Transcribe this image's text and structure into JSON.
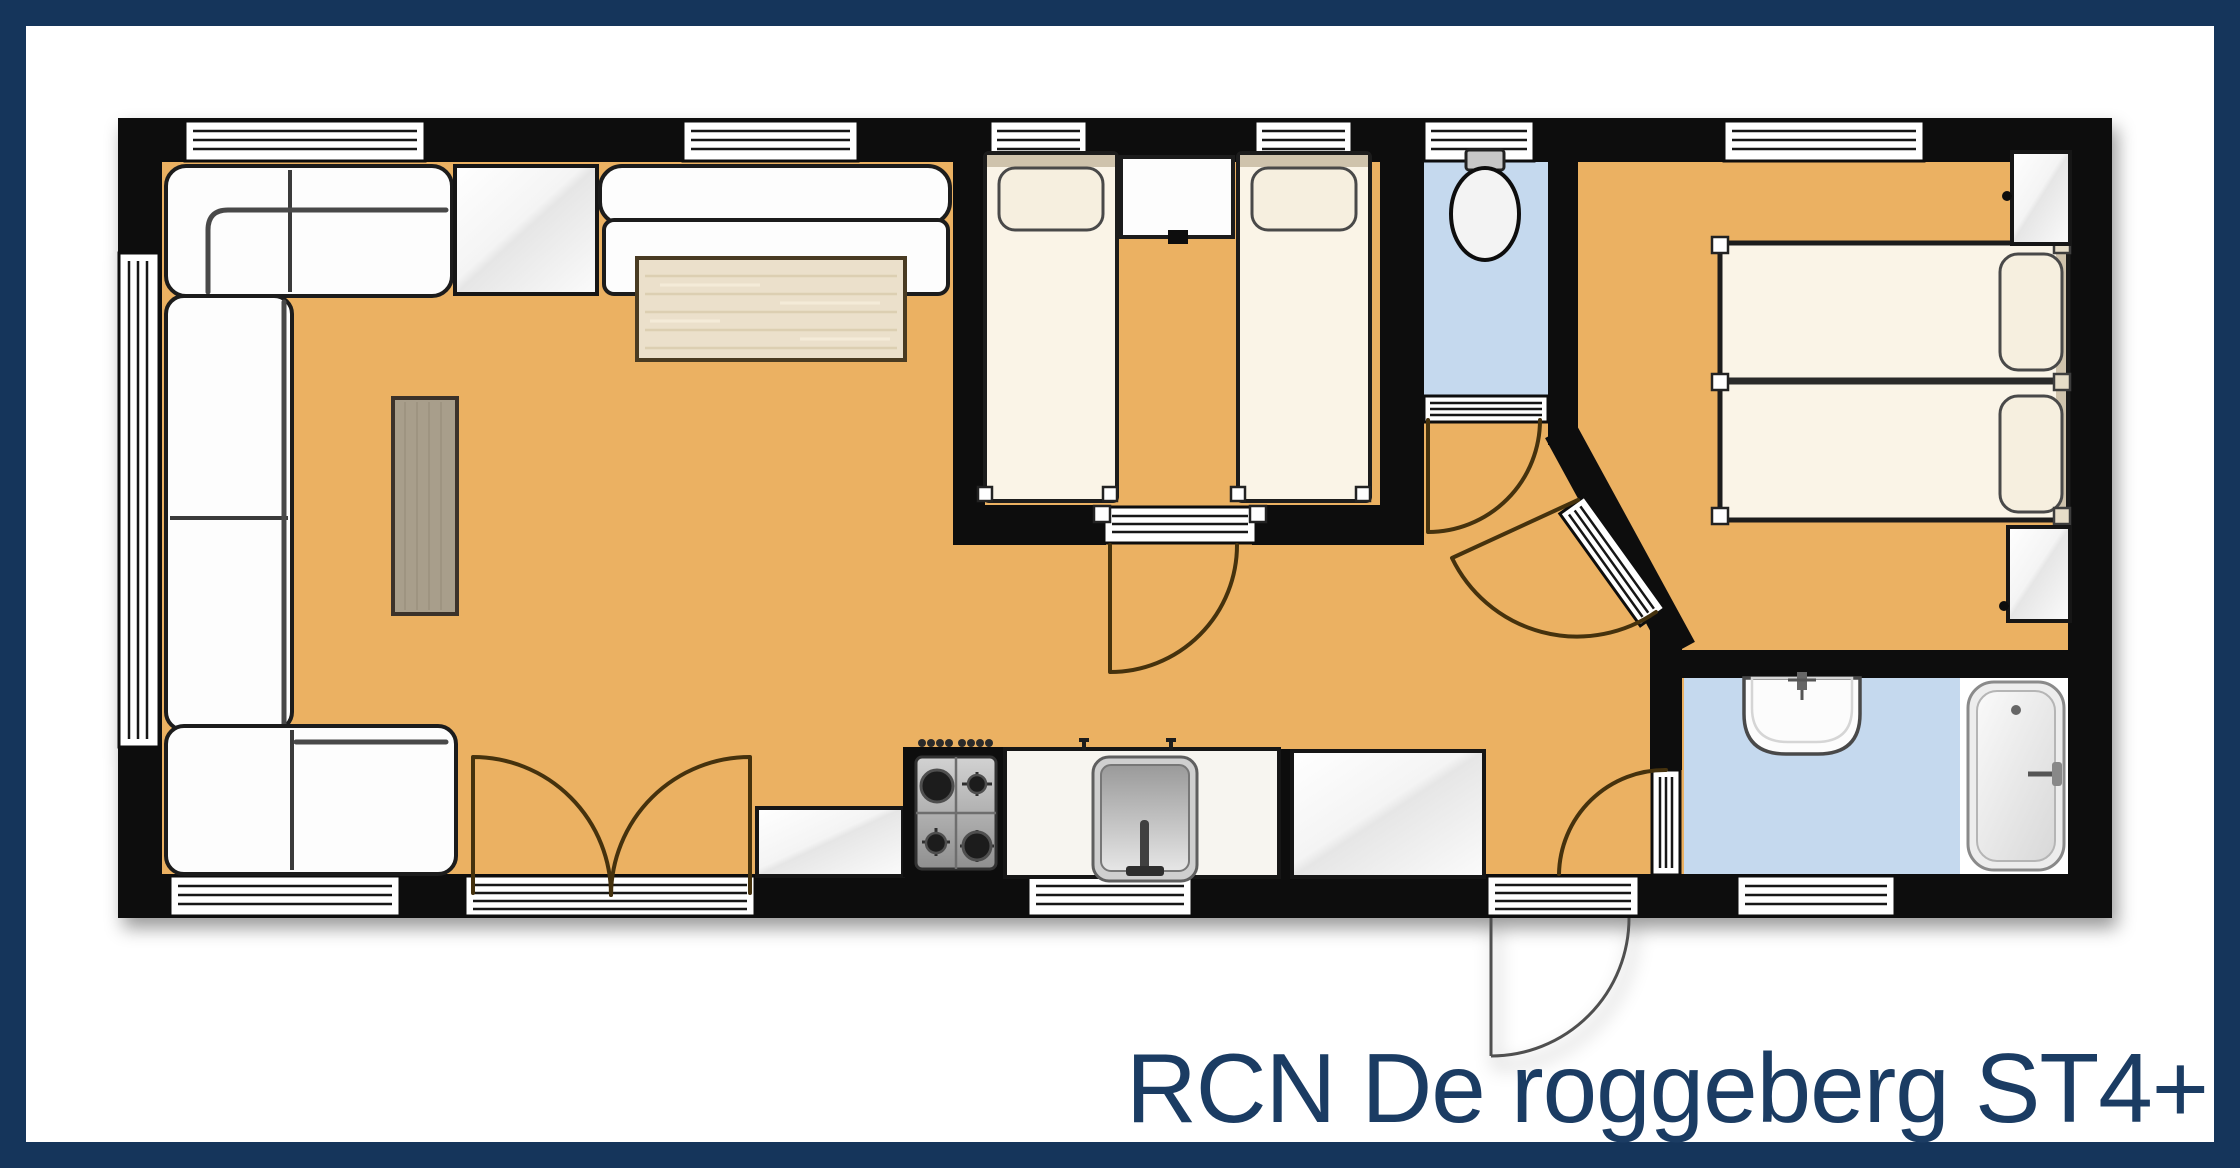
{
  "page": {
    "background": "#ffffff",
    "frame_color": "#15355b"
  },
  "title": {
    "label": "RCN De roggeberg ST4+",
    "color": "#1b3c63"
  },
  "palette": {
    "floor_wood": "#ebb162",
    "floor_wet": "#c5d9ee",
    "wall": "#101010",
    "furniture_white": "#fdfdfd",
    "bed_cream": "#faf4e7",
    "pillow_cream": "#f6efdf",
    "headboard_tan": "#cfc3ac",
    "dining_table_wood": "#ebe0cb",
    "coffee_table_wood": "#a89e8b",
    "door_arc": "#45300f",
    "metal": "#b5b5b5"
  }
}
